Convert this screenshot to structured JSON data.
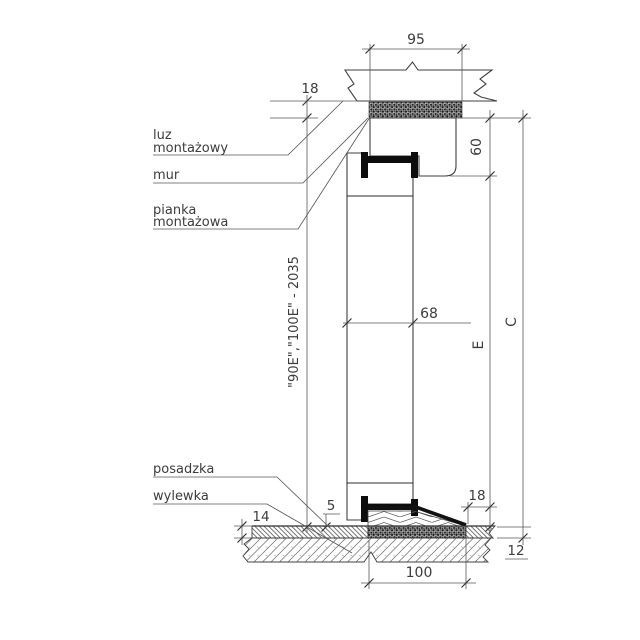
{
  "drawing": {
    "type": "door-frame-vertical-section",
    "background": "#ffffff",
    "line_color": "#3f3f3f",
    "callouts": {
      "luz": {
        "l1": "luz",
        "l2": "montażowy"
      },
      "mur": {
        "l1": "mur"
      },
      "pianka": {
        "l1": "pianka",
        "l2": "montażowa"
      },
      "posadzka": {
        "l1": "posadzka"
      },
      "wylewka": {
        "l1": "wylewka"
      }
    },
    "dims": {
      "d95": "95",
      "d18_top": "18",
      "d60": "60",
      "d68": "68",
      "dE": "E",
      "dC": "C",
      "d_opening": "\"90E\",\"100E\" - 2035",
      "d5": "5",
      "d14": "14",
      "d18_bottom": "18",
      "d12": "12",
      "d100": "100"
    },
    "materials": {
      "wall_hatch": "masonry-diagonal",
      "foam_fill": "dark-stipple",
      "frame_fill": "wood-chevron",
      "core_fill": "honeycomb",
      "floor_finish_fill": "diagonal-dense",
      "screed_fill": "diagonal-light"
    }
  }
}
